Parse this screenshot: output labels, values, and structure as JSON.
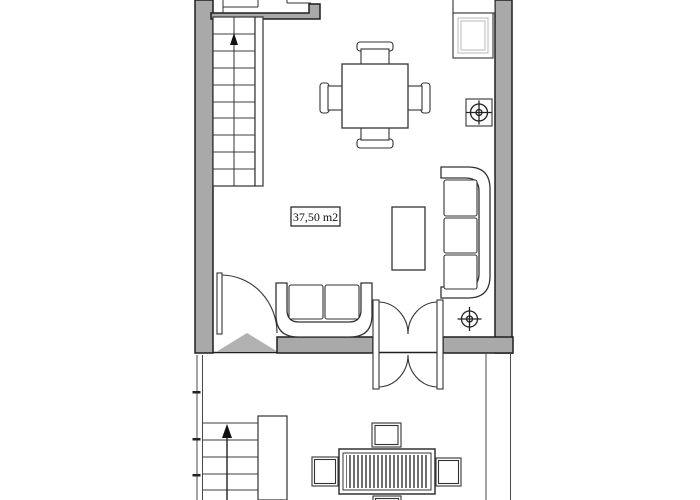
{
  "floor_plan": {
    "area_label": "37,50 m2",
    "colors": {
      "background": "#ffffff",
      "wall_fill": "#a9a9a9",
      "outline": "#1f1f1f",
      "threshold_triangle": "#b1b1b1",
      "inset_light_gray": "#c4c4c4"
    },
    "rooms": [
      {
        "name": "living-room",
        "area_label": "37,50 m2"
      }
    ],
    "furniture": [
      "dining-table",
      "dining-chair-top",
      "dining-chair-bottom",
      "dining-chair-left",
      "dining-chair-right",
      "kitchen-counter",
      "kitchen-sink-unit",
      "sofa-three-seat",
      "coffee-table",
      "loveseat-two-seat",
      "outdoor-table",
      "outdoor-chair-top",
      "outdoor-chair-left",
      "outdoor-chair-right",
      "outdoor-chair-bottom"
    ],
    "features": [
      "staircase-upper",
      "stair-up-arrow",
      "entry-door",
      "entry-threshold-triangle",
      "double-swing-door",
      "terrace",
      "terrace-railing",
      "terrace-staircase",
      "light-fixture-boxed-symbol",
      "light-fixture-symbol"
    ]
  }
}
